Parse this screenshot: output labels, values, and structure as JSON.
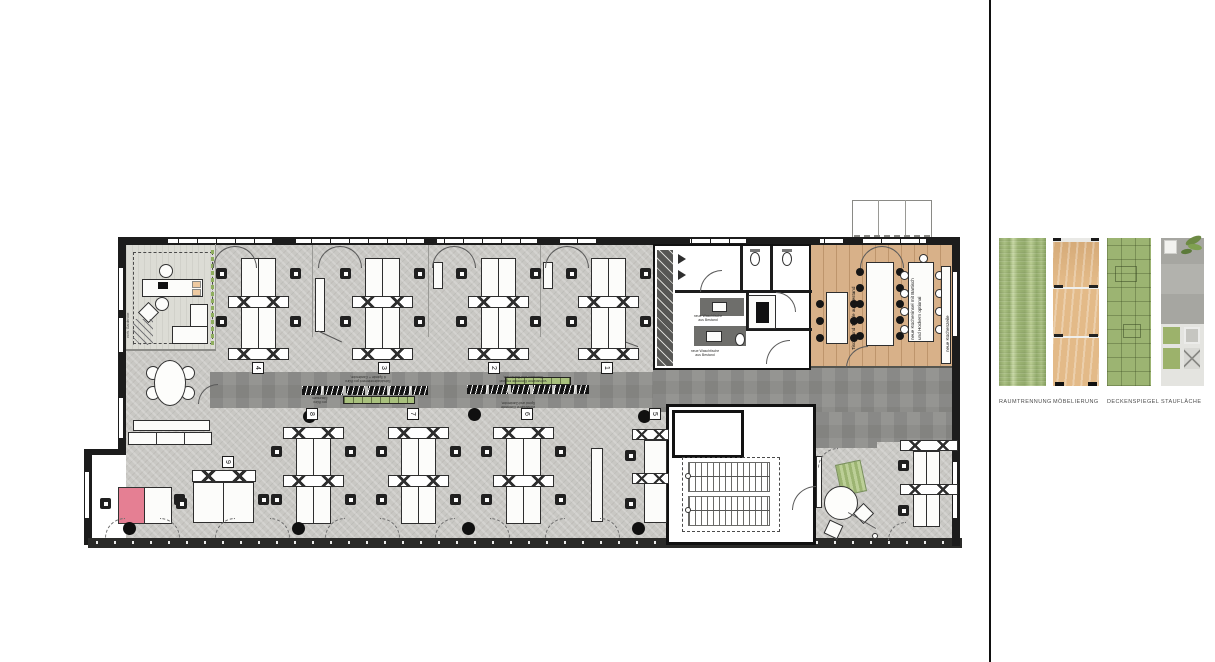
{
  "materials": {
    "items": [
      {
        "name": "raumtrennung",
        "label": "RAUMTRENNUNG",
        "swatch": "green vertical fabric"
      },
      {
        "name": "moebelierung",
        "label": "MÖBELIERUNG",
        "swatch": "wood cabinet front"
      },
      {
        "name": "deckenspiegel",
        "label": "DECKENSPIEGEL",
        "swatch": "green ceiling tiles"
      },
      {
        "name": "stauflaeche",
        "label": "STAUFLÄCHE",
        "swatch": "shelving photo with plant"
      }
    ]
  },
  "plan": {
    "workstation_groups": [
      {
        "number": "4"
      },
      {
        "number": "3"
      },
      {
        "number": "2"
      },
      {
        "number": "1"
      },
      {
        "number": "8"
      },
      {
        "number": "7"
      },
      {
        "number": "6"
      },
      {
        "number": "5"
      },
      {
        "number": "9"
      }
    ],
    "kitchen": {
      "tables": "Tische und Stühle aus Bestand",
      "island_line1": "neue Kücheninsel mit Bartisch",
      "island_line2": "und Hockern optional",
      "kitchenette": "neue Küchenzeile"
    },
    "micro_notes": {
      "lockers_a1": "6 Spinde + Garderobe,",
      "lockers_a2": "Schubladenelement pro Büro",
      "lockers_b1": "Stauraum und Garderobe,",
      "lockers_b2": "vorhandene Elemente ergänzt",
      "lockers_c1": "Spind und Garderobe,",
      "lockers_c2": "vorhandene Elemente",
      "lockers_d1": "Stauraum",
      "lockers_d2": "pro Büro",
      "wc_a1": "neue Waschtische",
      "wc_a2": "aus Bestand",
      "wc_b1": "neue Waschtische",
      "wc_b2": "aus Bestand",
      "lounge_side": "vorh. Garderobe"
    }
  },
  "colors": {
    "wall": "#1c1c1c",
    "floor": "#c9c8c4",
    "corridor": "#8e8e8b",
    "wood_floor": "#d8b189",
    "accent_green": "#a5bd7d",
    "highlight_pink": "#e57f93",
    "lounge_floor": "#dcdcd5"
  }
}
